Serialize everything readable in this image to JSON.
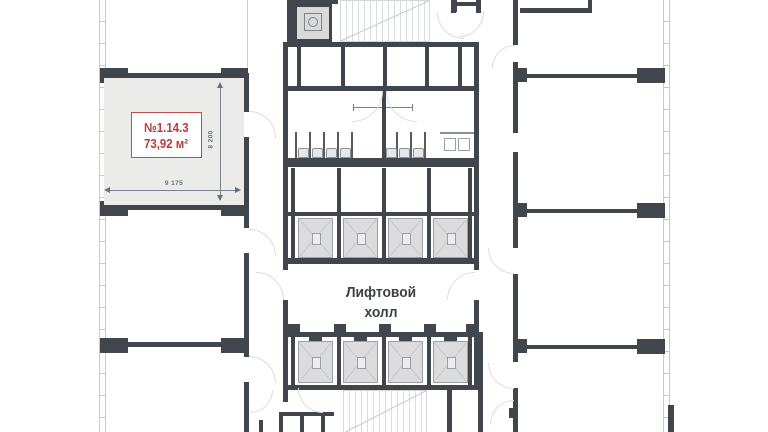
{
  "unit": {
    "number": "№1.14.3",
    "area": "73,92 м²",
    "dim_width_mm": "9 175",
    "dim_height_mm": "8 200"
  },
  "elevator_hall": {
    "label_line1": "Лифтовой",
    "label_line2": "холл"
  },
  "colors": {
    "wall": "#41464d",
    "unit_fill": "#ebebe9",
    "unit_accent": "#c13a3c",
    "elevator_fill": "#dcdcde",
    "stair_hatch": "#d9dce0",
    "annotation": "#6b7077"
  }
}
